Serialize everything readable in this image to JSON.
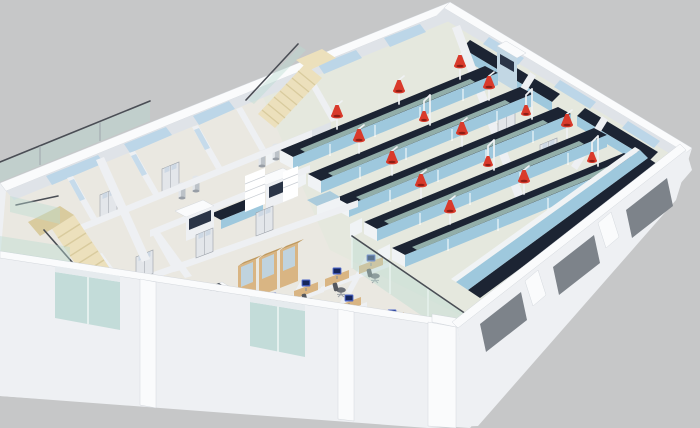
{
  "image": {
    "alt": "3D isometric cutaway rendering of a laboratory building floor plan on a plain gray background. The right half is an open laboratory with five long island benches (dark navy tops, light-blue base cabinets, glass reagent shelves) fitted with red snorkel fume-extraction arms on white poles. The left half holds two cream wooden staircases, small rooms with double doors along the back corridor, a fume-hood room with chrome exhaust stacks, wooden display cabinets, and an open-plan office with timber desks, blue computer monitors and gray task chairs. Exterior walls are thick and white with pale-blue back windows, green-tinted front glazing and gray recessed windows on the near facade.",
    "type": "architectural-3d-render",
    "view": "isometric cutaway, no roof, cropped at left edge"
  },
  "palette": {
    "bg": "#c6c7c8",
    "wall_top": "#fafbfc",
    "wall_face": "#eef0f3",
    "wall_shade": "#dfe3e8",
    "wall_dark": "#cfd4da",
    "floor": "#eae8e1",
    "floor_lab": "#e3e7dd",
    "bench_top": "#1c2433",
    "bench_front": "#9ec8dd",
    "bench_white": "#f0f3f5",
    "glass_teal": "#b9dcd2",
    "window_blue": "#bcd6e8",
    "window_gray": "#7d838a",
    "glass_front": "#c3dcd9",
    "red_hood": "#d93a2b",
    "red_hood_dark": "#8e1d14",
    "arm_white": "#f0f2f4",
    "wood": "#d9b583",
    "wood_dark": "#c09a5f",
    "stair": "#ece0bc",
    "stair_shade": "#d9cb9e",
    "monitor_blue": "#4a63c8",
    "monitor_screen": "#16265c",
    "chair_gray": "#6d7178",
    "chair_dark": "#55585f",
    "chrome": "#bcc2c8",
    "rail": "#4a4e55"
  },
  "scene": {
    "areas": [
      {
        "name": "main-laboratory",
        "items": "5 island benches with reagent shelves and red snorkel extractor arms"
      },
      {
        "name": "right-lab-rooms",
        "items": "2 small lab rooms with wall benches and a biosafety cabinet"
      },
      {
        "name": "fume-hood-room",
        "items": "2 fume hoods with chrome exhaust stacks, dark counter, shelving, sink unit"
      },
      {
        "name": "open-plan-office",
        "items": "7 cubicle clusters with timber desks, monitors and chairs"
      },
      {
        "name": "back-corridor-rooms",
        "items": "small rooms with double doors and clerestory glazing"
      },
      {
        "name": "staircases",
        "items": "2 cream wooden staircases with glass balustrades"
      }
    ],
    "counts": {
      "island_benches": 5,
      "red_extractor_arms": 16,
      "fume_hoods": 2,
      "chrome_stacks": 4,
      "staircases": 2,
      "office_desks": 14,
      "monitors": 16,
      "office_chairs": 13,
      "doors": 9,
      "back_windows": 5,
      "gray_facade_windows": 3,
      "front_glass_windows": 2,
      "display_cabinets": 3,
      "biosafety_cabinets": 1
    }
  }
}
